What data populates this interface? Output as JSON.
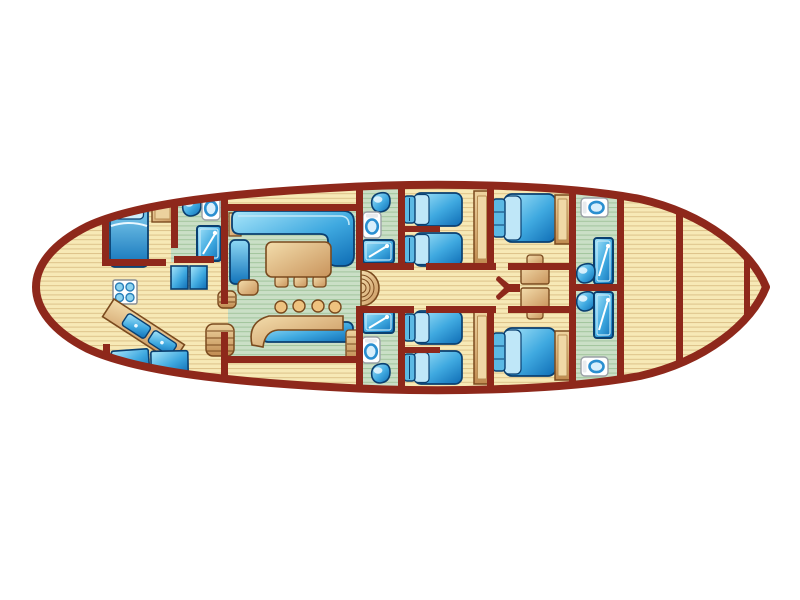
{
  "diagram": {
    "type": "boat-deck-floor-plan",
    "orientation": {
      "bow": "right",
      "stern": "left",
      "top_side": "port",
      "bottom_side": "starboard"
    },
    "colors": {
      "background": "#ffffff",
      "hull_and_walls": "#8e281b",
      "deck_plank": "#f7e9b6",
      "deck_plank_line": "#dcc289",
      "wet_room_floor": "#cadfc6",
      "wet_room_line": "#a2c49d",
      "upholstery_blue": "#3fa9e0",
      "wood_tan": "#d9ab6e",
      "fixture_white": "#ffffff"
    },
    "totals": {
      "guest_cabins": 5,
      "bathrooms": 5,
      "guest_berths": 9,
      "crew_berths": 2
    }
  },
  "rooms": [
    {
      "id": "aft-deck",
      "furniture": []
    },
    {
      "id": "aft-cabin",
      "furniture": [
        "single-bed",
        "side-hatch"
      ]
    },
    {
      "id": "aft-bathroom",
      "furniture": [
        "washbasin",
        "toilet",
        "shower"
      ]
    },
    {
      "id": "galley",
      "furniture": [
        "stove-4-burner",
        "fridge",
        "fridge",
        "double-sink-counter",
        "crew-berth",
        "crew-berth",
        "companionway-steps",
        "step-barrel"
      ]
    },
    {
      "id": "salon",
      "furniture": [
        "l-sofa",
        "side-sofa",
        "corner-shelf",
        "dining-table",
        "dining-chair",
        "dining-chair",
        "dining-chair",
        "stool",
        "bar-counter",
        "back-counter",
        "bar-stool",
        "bar-stool",
        "bar-stool",
        "bar-stool",
        "steps"
      ]
    },
    {
      "id": "corridor",
      "furniture": [
        "staircase",
        "mast-foot",
        "table",
        "seat",
        "seat"
      ]
    },
    {
      "id": "bathroom-port-mid",
      "furniture": [
        "washbasin",
        "toilet",
        "shower"
      ]
    },
    {
      "id": "twin-cabin-port",
      "furniture": [
        "single-bed",
        "single-bed",
        "wardrobe"
      ]
    },
    {
      "id": "double-cabin-port",
      "furniture": [
        "double-bed",
        "wardrobe"
      ]
    },
    {
      "id": "bathroom-port-bow",
      "furniture": [
        "toilet",
        "shower",
        "washbasin"
      ]
    },
    {
      "id": "bathroom-starboard-mid",
      "furniture": [
        "shower",
        "toilet",
        "washbasin"
      ]
    },
    {
      "id": "twin-cabin-starboard",
      "furniture": [
        "single-bed",
        "single-bed",
        "wardrobe"
      ]
    },
    {
      "id": "double-cabin-starboard",
      "furniture": [
        "double-bed",
        "wardrobe"
      ]
    },
    {
      "id": "bathroom-starboard-bow",
      "furniture": [
        "washbasin",
        "shower",
        "toilet"
      ]
    },
    {
      "id": "fore-peak",
      "furniture": []
    },
    {
      "id": "bow-locker",
      "furniture": []
    }
  ]
}
